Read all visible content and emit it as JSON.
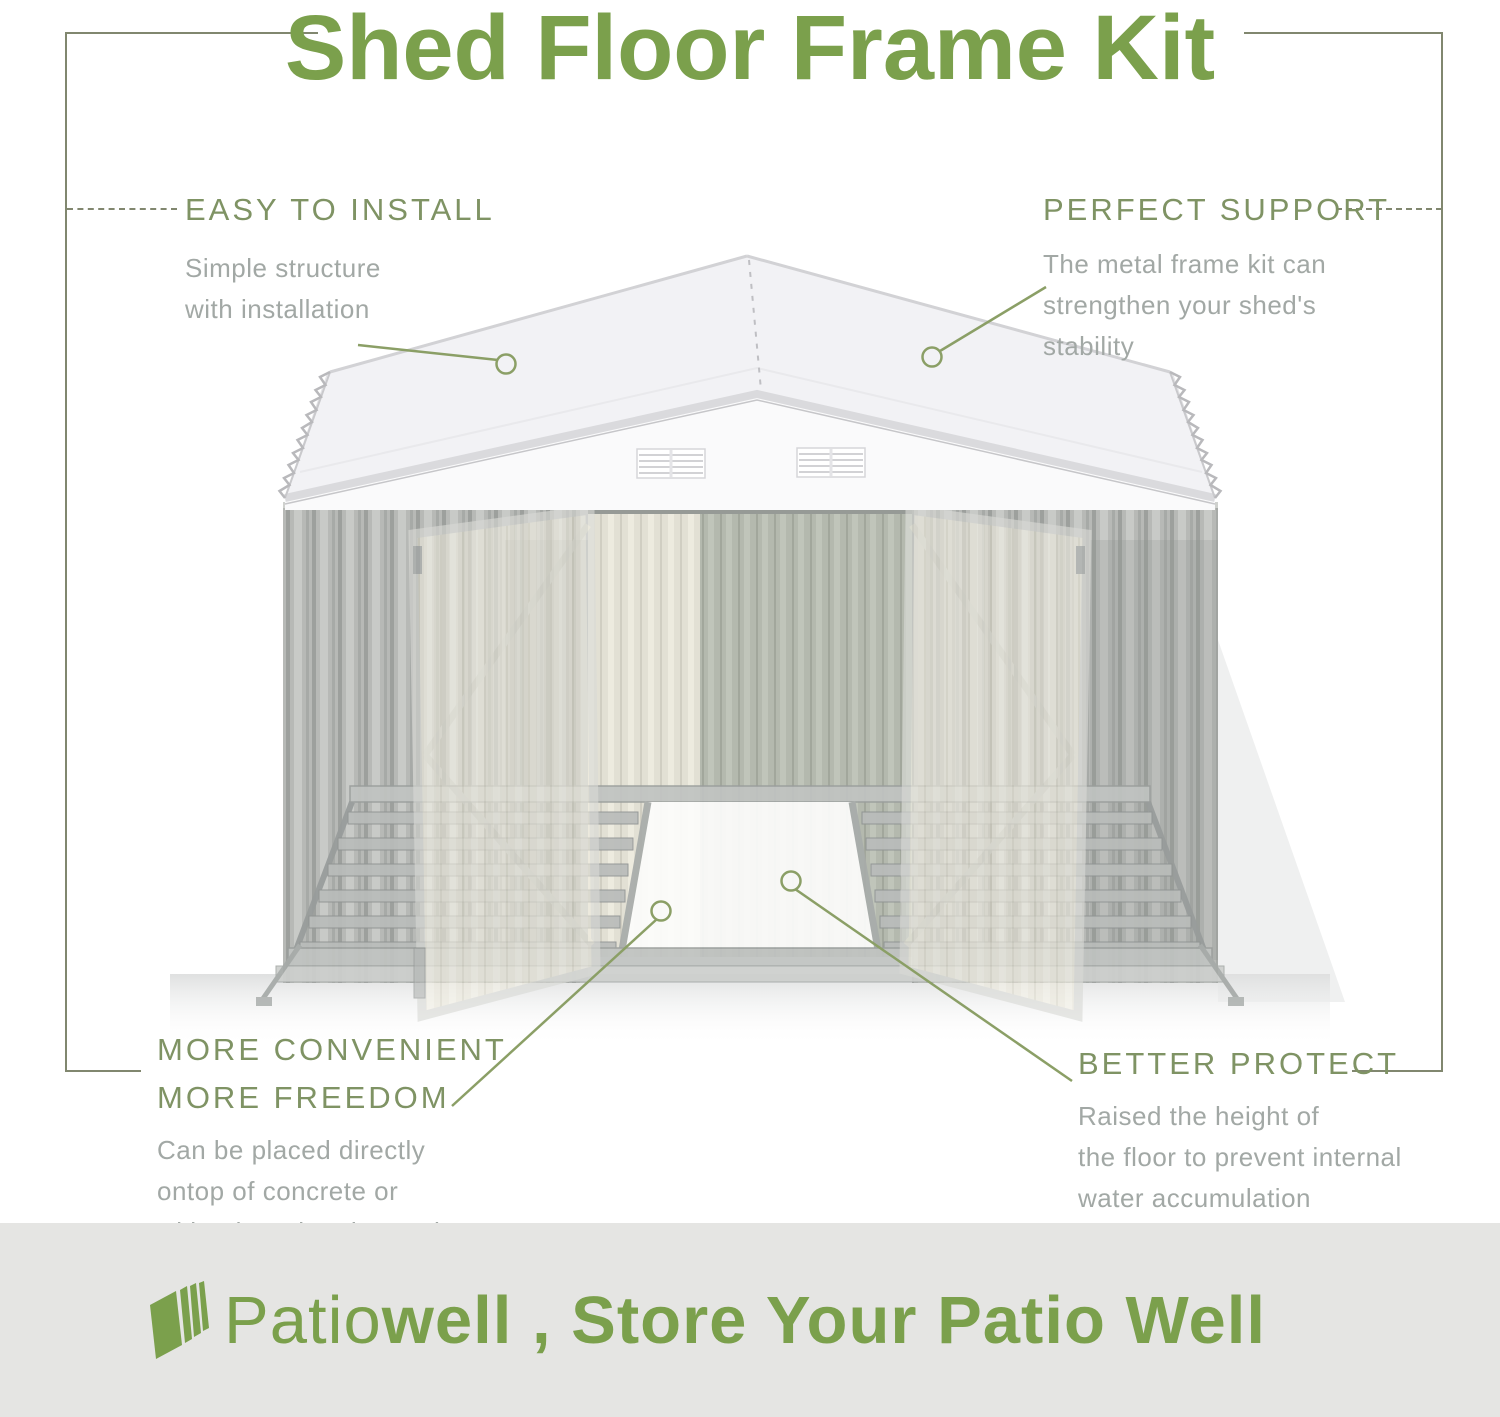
{
  "title": "Shed Floor Frame Kit",
  "callouts": {
    "easy": {
      "heading": "EASY TO INSTALL",
      "body": "Simple structure\nwith installation"
    },
    "support": {
      "heading": "PERFECT SUPPORT",
      "body": "The metal frame kit can\nstrengthen your shed's\nstability"
    },
    "convenient": {
      "heading": "MORE CONVENIENT\nMORE FREEDOM",
      "body": "Can be placed directly\nontop of concrete or\nwith a board underneath"
    },
    "protect": {
      "heading": "BETTER PROTECT",
      "body": "Raised the height of\nthe floor to prevent internal\nwater accumulation"
    }
  },
  "footer": {
    "brand_light": "Patio",
    "brand_bold": "well",
    "tagline": " , Store Your Patio Well",
    "logo_icon": "patiowell-stacked-panels-icon"
  },
  "colors": {
    "brand-green": "#7ba04c",
    "heading-green": "#7f9364",
    "body-gray": "#a2a8a5",
    "leader-green": "#8b9f66",
    "frame-line": "#81876f",
    "banner-bg": "#e5e5e3"
  }
}
